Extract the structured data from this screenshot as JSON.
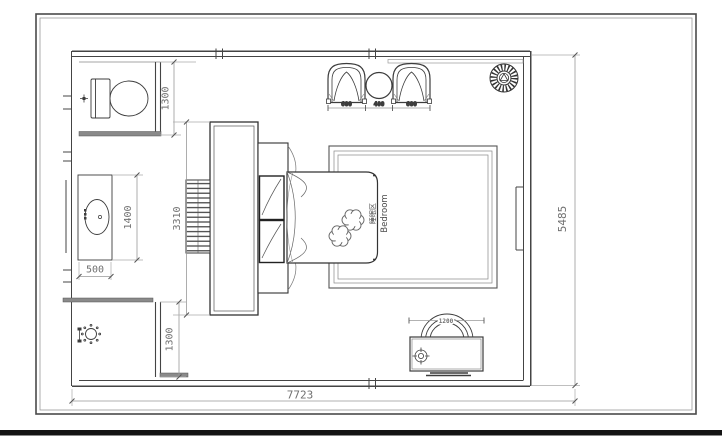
{
  "drawing": {
    "labels": {
      "area_zh": "睡眠区",
      "area_en": "Bedroom"
    },
    "dimensions": {
      "toilet_room_depth": "1300",
      "vanity_length": "1400",
      "vanity_width": "500",
      "wardrobe_run": "3310",
      "shower_room_depth": "1300",
      "room_depth": "5485",
      "room_width": "7723",
      "armchair_left_width": "600",
      "side_table_width": "400",
      "armchair_right_width": "600",
      "desk_width": "1200"
    },
    "icons": {
      "toilet": "toilet-icon",
      "sink": "sink-icon",
      "shower": "shower-head-icon",
      "ceiling_fan": "ceiling-fan-icon",
      "lamp": "lamp-icon",
      "armchairs": "armchair-icon",
      "side_table": "side-table-icon",
      "desk_chair": "desk-chair-icon"
    },
    "colors": {
      "wall": "#444444",
      "furniture": "#3c3c3c",
      "dimension_line": "#999999",
      "dimension_text": "#707070",
      "background": "#ffffff"
    }
  }
}
